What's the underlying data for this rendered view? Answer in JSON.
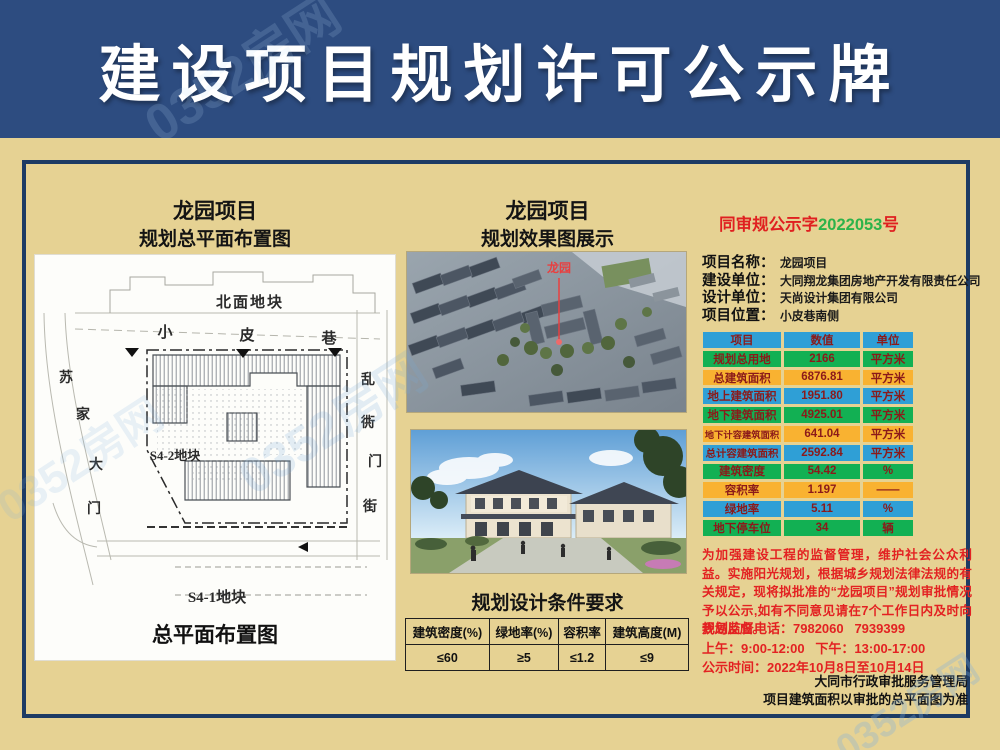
{
  "banner": {
    "title": "建设项目规划许可公示牌"
  },
  "watermark": "0352房网",
  "left": {
    "title": "龙园项目",
    "subtitle": "规划总平面布置图",
    "plan": {
      "north_parcel": "北面地块",
      "street_top": "小皮巷",
      "street_left": "苏家大门",
      "street_right": "乱衖门街",
      "parcel_s42": "S4-2地块",
      "parcel_s41": "S4-1地块",
      "caption": "总平面布置图"
    }
  },
  "middle": {
    "title": "龙园项目",
    "subtitle": "规划效果图展示",
    "render_label": "龙园",
    "conditions": {
      "heading": "规划设计条件要求",
      "headers": [
        "建筑密度(%)",
        "绿地率(%)",
        "容积率",
        "建筑高度(M)"
      ],
      "values": [
        "≤60",
        "≥5",
        "≤1.2",
        "≤9"
      ]
    }
  },
  "right": {
    "doc_no": {
      "prefix": "同审规公示字",
      "number": "2022053",
      "suffix": "号"
    },
    "info": [
      {
        "label": "项目名称：",
        "value": "龙园项目"
      },
      {
        "label": "建设单位：",
        "value": "大同翔龙集团房地产开发有限责任公司"
      },
      {
        "label": "设计单位：",
        "value": "天尚设计集团有限公司"
      },
      {
        "label": "项目位置：",
        "value": "小皮巷南侧"
      }
    ],
    "table": {
      "headers": [
        "项目",
        "数值",
        "单位"
      ],
      "rows": [
        [
          "规划总用地",
          "2166",
          "平方米"
        ],
        [
          "总建筑面积",
          "6876.81",
          "平方米"
        ],
        [
          "地上建筑面积",
          "1951.80",
          "平方米"
        ],
        [
          "地下建筑面积",
          "4925.01",
          "平方米"
        ],
        [
          "地下计容建筑面积",
          "641.04",
          "平方米"
        ],
        [
          "总计容建筑面积",
          "2592.84",
          "平方米"
        ],
        [
          "建筑密度",
          "54.42",
          "%"
        ],
        [
          "容积率",
          "1.197",
          "——"
        ],
        [
          "绿地率",
          "5.11",
          "%"
        ],
        [
          "地下停车位",
          "34",
          "辆"
        ]
      ]
    },
    "notice": "为加强建设工程的监督管理，维护社会公众利益。实施阳光规划，根据城乡规划法律法规的有关规定，现将拟批准的“龙园项目”规划审批情况予以公示,如有不同意见请在7个工作日内及时向我局反应。",
    "phone_line": "规划监督电话：7982060   7939399",
    "hours_line": "上午：9:00-12:00   下午：13:00-17:00",
    "publicity_line": "公示时间：2022年10月8日至10月14日",
    "agency": "大同市行政审批服务管理局",
    "note": "项目建筑面积以审批的总平面图为准"
  },
  "colors": {
    "banner_bg": "#2d4c80",
    "body_bg": "#e6d293",
    "frame_border": "#1d3b64",
    "table_blue": "#2f9fd6",
    "table_green": "#12b053",
    "table_orange": "#f9b231",
    "table_text": "#8b1a1a",
    "notice_red": "#e32222",
    "doc_green": "#2db34a"
  }
}
